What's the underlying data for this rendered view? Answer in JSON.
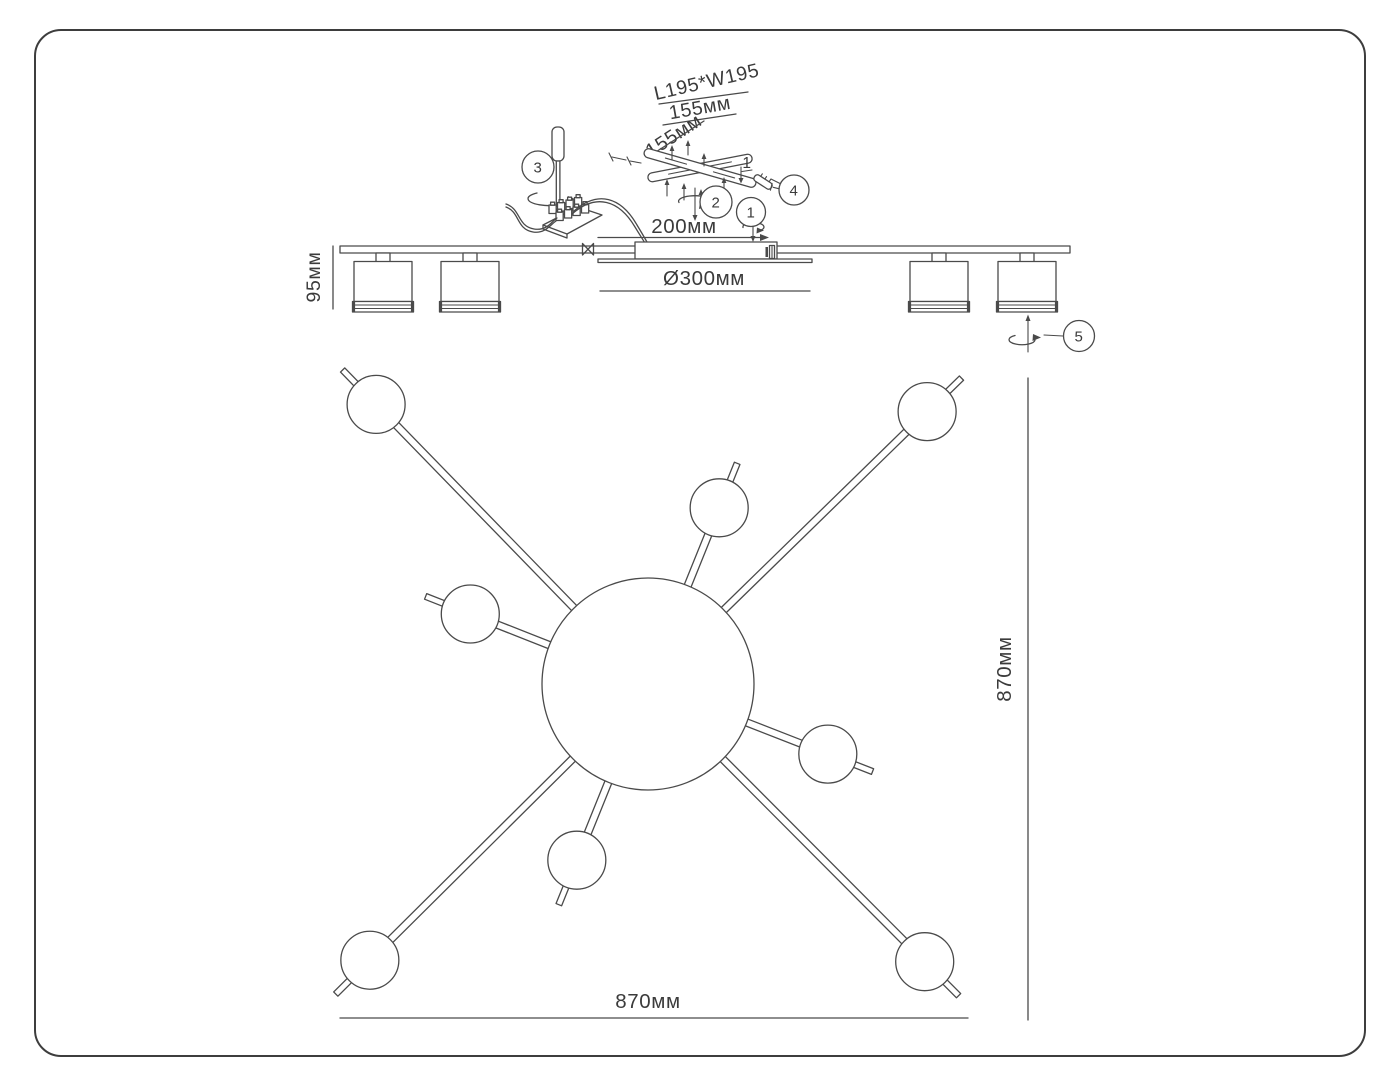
{
  "description": "Assembly and dimension diagram of an 8-light ceiling chandelier",
  "colors": {
    "background": "#ffffff",
    "frame": "#3d3d3d",
    "line": "#4a4a4a",
    "text": "#3b3b3b"
  },
  "installation": {
    "plate_size_label": "L195*W195",
    "bracket_width_label": "155мм",
    "bracket_depth_label": "155мм",
    "screw_item_label": "1"
  },
  "side_view": {
    "fixture_height_label": "95мм",
    "canopy_length_label": "200мм",
    "canopy_diameter_label": "Ø300мм",
    "lamp_heads_visible": 4
  },
  "plan_view": {
    "overall_width_label": "870мм",
    "overall_height_label": "870мм",
    "lamp_heads": 8
  },
  "callouts": {
    "step1": "1",
    "step2": "2",
    "step3": "3",
    "step4": "4",
    "step5": "5"
  }
}
